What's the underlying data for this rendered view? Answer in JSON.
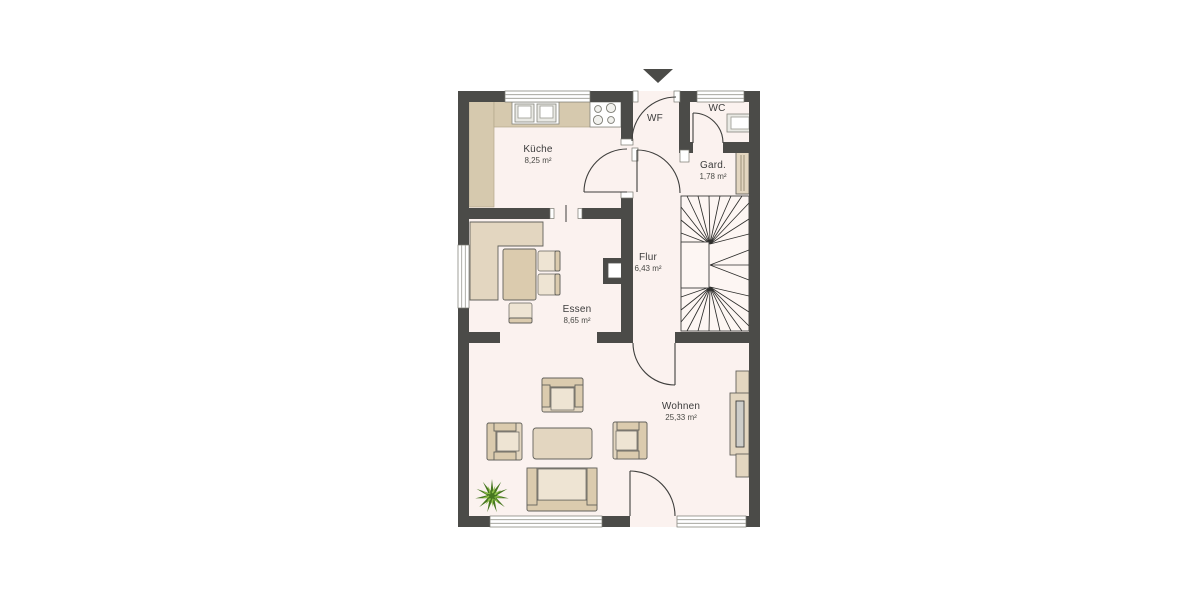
{
  "plan": {
    "title_hint": "floor-plan",
    "colors": {
      "page": "#ffffff",
      "wall": "#4b4b48",
      "floor": "#fbf2ef",
      "counter": "#d6c9ae",
      "furniture": "#e3d6c0",
      "furniture_dark": "#dbcbae",
      "furniture_light": "#eee4d3",
      "furniture_outline": "#63625c",
      "line": "#3f3f3d",
      "plant_dark": "#46761f",
      "plant_light": "#8fc04a",
      "text": "#3c3c3c"
    },
    "rooms": [
      {
        "name": "Küche",
        "area": "8,25 m²"
      },
      {
        "name": "WF",
        "area": ""
      },
      {
        "name": "WC",
        "area": ""
      },
      {
        "name": "Gard.",
        "area": "1,78 m²"
      },
      {
        "name": "Flur",
        "area": "6,43 m²"
      },
      {
        "name": "Essen",
        "area": "8,65 m²"
      },
      {
        "name": "Wohnen",
        "area": "25,33 m²"
      }
    ]
  }
}
